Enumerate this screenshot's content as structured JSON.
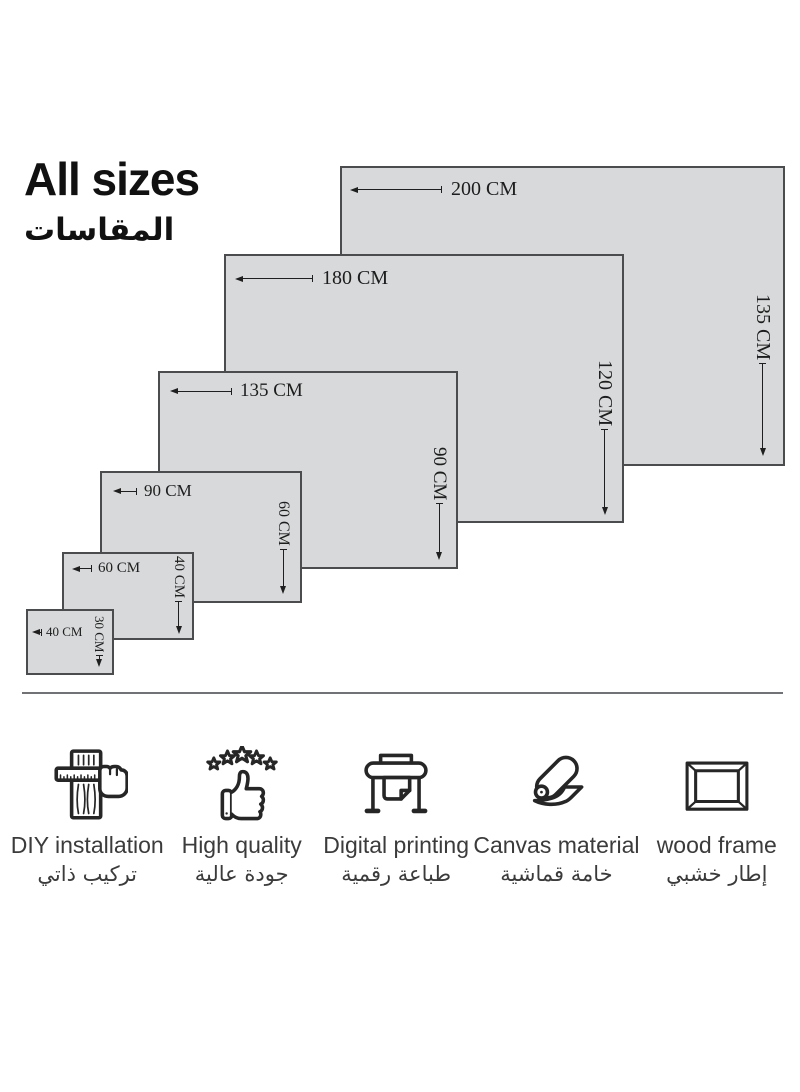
{
  "title": {
    "en": "All sizes",
    "ar": "المقاسات"
  },
  "diagram": {
    "unit": "CM",
    "fill_color": "#d8d9da",
    "border_color": "#4b4c4e",
    "sizes": [
      {
        "width_label": "200 CM",
        "height_label": "135 CM"
      },
      {
        "width_label": "180 CM",
        "height_label": "120 CM"
      },
      {
        "width_label": "135 CM",
        "height_label": "90 CM"
      },
      {
        "width_label": "90 CM",
        "height_label": "60 CM"
      },
      {
        "width_label": "60 CM",
        "height_label": "40 CM"
      },
      {
        "width_label": "40 CM",
        "height_label": "30 CM"
      }
    ]
  },
  "features": [
    {
      "icon": "diy-installation-icon",
      "label_en": "DIY installation",
      "label_ar": "تركيب ذاتي"
    },
    {
      "icon": "high-quality-icon",
      "label_en": "High quality",
      "label_ar": "جودة عالية"
    },
    {
      "icon": "digital-printing-icon",
      "label_en": "Digital printing",
      "label_ar": "طباعة رقمية"
    },
    {
      "icon": "canvas-material-icon",
      "label_en": "Canvas material",
      "label_ar": "خامة قماشية"
    },
    {
      "icon": "wood-frame-icon",
      "label_en": "wood frame",
      "label_ar": "إطار خشبي"
    }
  ]
}
